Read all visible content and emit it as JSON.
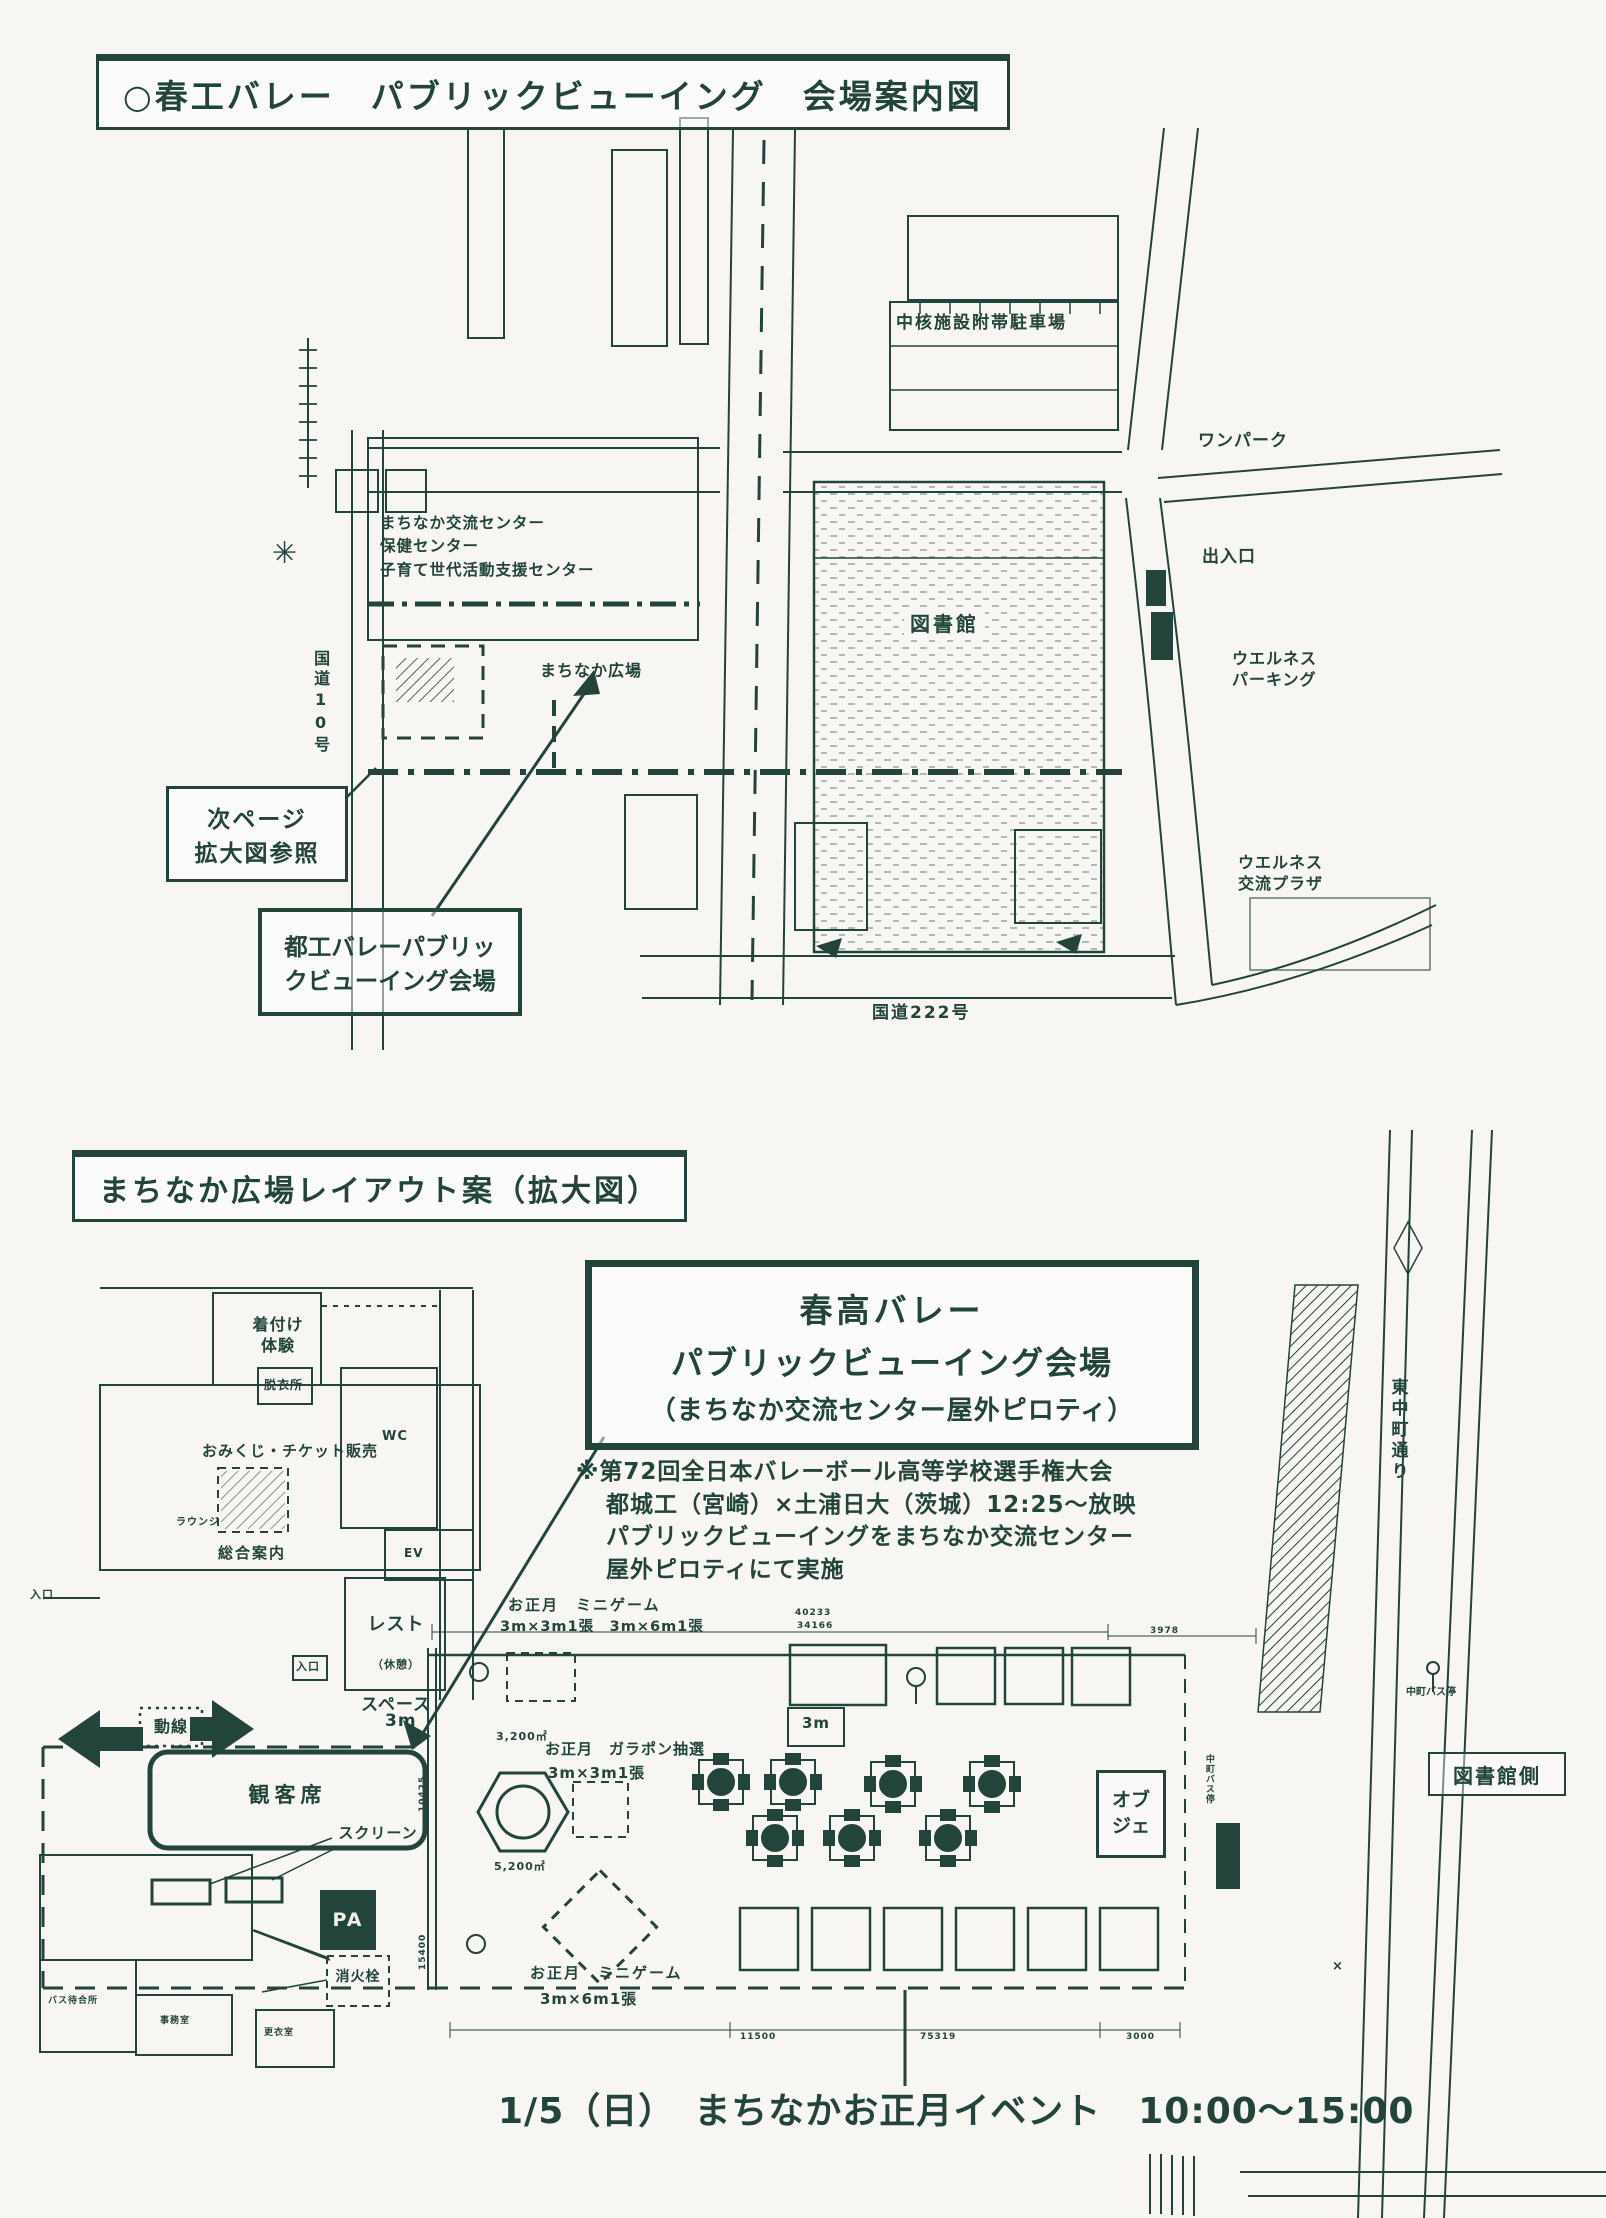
{
  "colors": {
    "ink": "#23443a",
    "paper": "#f7f6f2"
  },
  "m1": {
    "title": "○春工バレー　パブリックビューイング　会場案内図",
    "parking": "中核施設附帯駐車場",
    "onepark": "ワンパーク",
    "gate": "出入口",
    "wellness_parking": "ウエルネス\nパーキング",
    "wellness_plaza": "ウエルネス\n交流プラザ",
    "library": "図書館",
    "center": "まちなか交流センター\n保健センター\n子育て世代活動支援センター",
    "hiroba": "まちなか広場",
    "route10": "国道10号",
    "route222": "国道222号",
    "next_page": "次ページ\n拡大図参照",
    "venue": "都工バレーパブリッ\nクビューイング会場"
  },
  "m2": {
    "title": "まちなか広場レイアウト案（拡大図）",
    "venue_line1": "春高バレー",
    "venue_line2": "パブリックビューイング会場",
    "venue_line3": "（まちなか交流センター屋外ピロティ）",
    "note1": "※第72回全日本バレーボール高等学校選手権大会",
    "note2": "都城工（宮崎）×土浦日大（茨城）12:25～放映",
    "note3": "パブリックビューイングをまちなか交流センター",
    "note4": "屋外ピロティにて実施",
    "kitsuke": "着付け\n体験",
    "datsuisho": "脱衣所",
    "omikuji": "おみくじ・チケット販売",
    "lounge": "ラウンジ",
    "sogo": "総合案内",
    "wc": "WC",
    "ev": "EV",
    "entrance_left": "入口",
    "entrance_mid": "入口",
    "rest1": "レスト",
    "rest2": "（休憩）",
    "rest3": "スペース",
    "dousen": "動線",
    "gap3m": "3m",
    "seats": "観客席",
    "screen": "スクリーン",
    "pa": "PA",
    "hydrant": "消火栓",
    "bus_wait": "バス待合所",
    "office": "事務室",
    "locker": "更衣室",
    "mini_top1": "お正月　ミニゲーム",
    "mini_top2": "3m×3m1張　3m×6m1張",
    "garapon1": "お正月　ガラポン抽選",
    "garapon2": "3m×3m1張",
    "hex_area_top": "3,200㎡",
    "hex_area_bottom": "5,200㎡",
    "tent3m": "3m",
    "mini_bottom1": "お正月　ミニゲーム",
    "mini_bottom2": "3m×6m1張",
    "obje": "オブ\nジェ",
    "library_side": "図書館側",
    "street": "東中町通り",
    "busstop": "中町バス停",
    "busstop_shelter": "中町バス停",
    "xmark": "×",
    "event": "1/5（日）　まちなかお正月イベント　10:00～15:00",
    "dims": {
      "d1": "40233",
      "d2": "34166",
      "d3": "3978",
      "d4": "11500",
      "d5": "75319",
      "d6": "3000",
      "d7": "10425",
      "d8": "15400"
    }
  }
}
